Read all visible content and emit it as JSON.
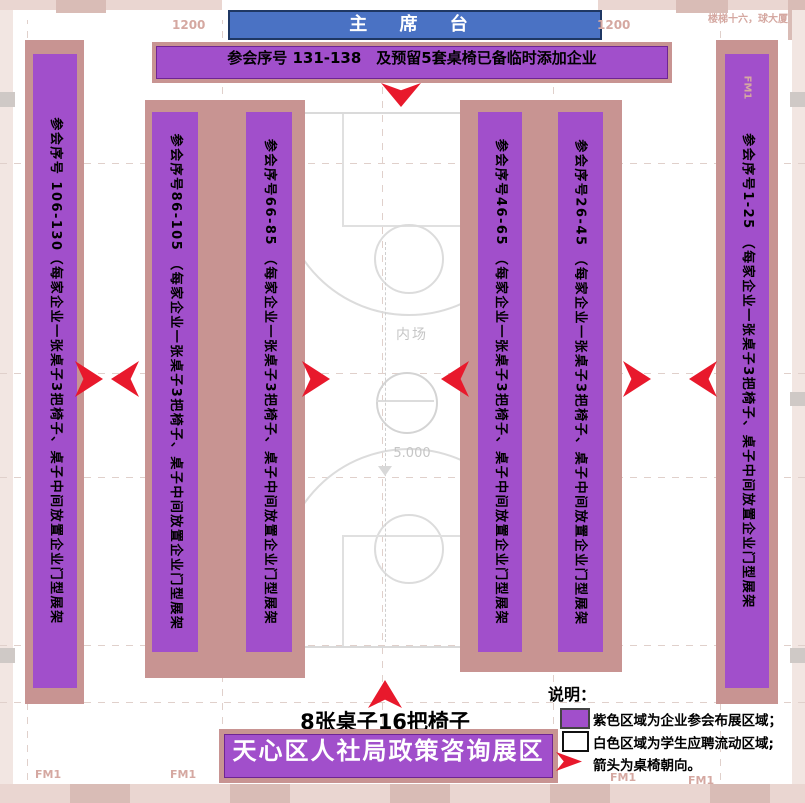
{
  "stage": {
    "label": "主 席 台"
  },
  "top_banner": {
    "text": "参会序号 131-138　及预留5套桌椅已备临时添加企业"
  },
  "columns": [
    {
      "range": "106-130",
      "facing": "right",
      "text": "参会序号 106-130（每家企业一张桌子3把椅子、桌子中间放置企业门型展架"
    },
    {
      "range": "86-105",
      "facing": "left",
      "text": "参会序号86-105 （每家企业一张桌子3把椅子、桌子中间放置企业门型展架"
    },
    {
      "range": "66-85",
      "facing": "right",
      "text": "参会序号66-85 （每家企业一张桌子3把椅子、桌子中间放置企业门型展架"
    },
    {
      "range": "46-65",
      "facing": "left",
      "text": "参会序号46-65 （每家企业一张桌子3把椅子、桌子中间放置企业门型展架"
    },
    {
      "range": "26-45",
      "facing": "right",
      "text": "参会序号26-45 （每家企业一张桌子3把椅子、桌子中间放置企业门型展架"
    },
    {
      "range": "1-25",
      "facing": "left",
      "text": "参会序号1-25 （每家企业一张桌子3把椅子、桌子中间放置企业门型展架"
    }
  ],
  "arrows": {
    "stage_arrow": "down",
    "bottom_arrow": "up",
    "row_arrows": [
      "right",
      "left",
      "right",
      "left",
      "right",
      "left"
    ]
  },
  "bottom": {
    "tables_note": "8张桌子16把椅子",
    "banner": "天心区人社局政策咨询展区"
  },
  "legend": {
    "title": "说明：",
    "items": [
      {
        "swatch": "purple-square",
        "text": "紫色区域为企业参会布展区域；"
      },
      {
        "swatch": "white-square",
        "text": "白色区域为学生应聘流动区域;"
      },
      {
        "swatch": "red-arrow",
        "text": "箭头为桌椅朝向。"
      }
    ]
  },
  "court": {
    "inner_label": "内场",
    "dimension": "5.000"
  },
  "cad": {
    "dim_label_left": "1200",
    "dim_label_right": "1200",
    "corner_label": "楼梯十六，球大厦",
    "fm_label": "FM1"
  },
  "colors": {
    "purple": "#A14FCB",
    "pink_frame": "#C89492",
    "stage_blue": "#4A72C4",
    "stage_border": "#1F3864",
    "arrow_red": "#E8192C",
    "court_gray": "#DADADA"
  }
}
